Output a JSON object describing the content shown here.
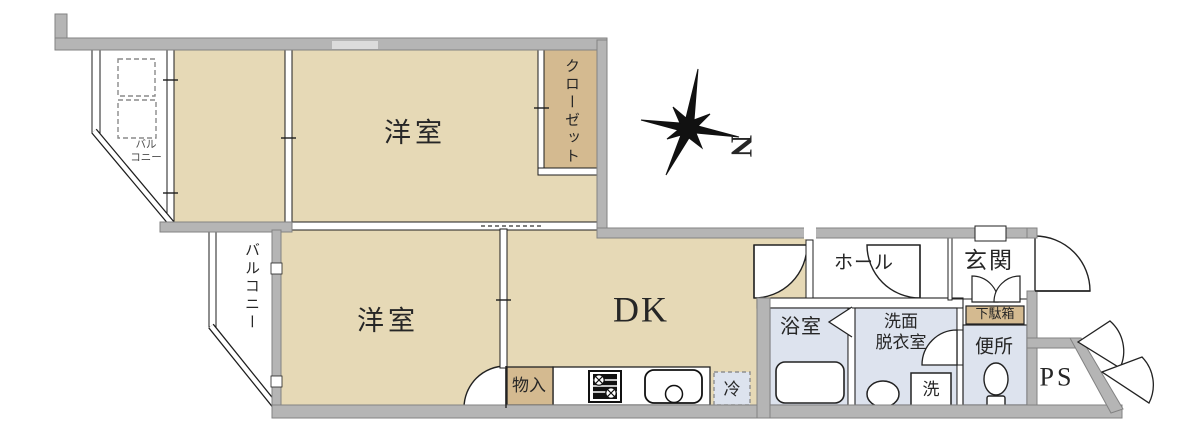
{
  "plan": {
    "title_hint": "apartment floor plan",
    "rooms": {
      "western_room_upper": "洋室",
      "western_room_lower": "洋室",
      "dining_kitchen": "DK",
      "closet": "クローゼット",
      "balcony_upper_l1": "バル",
      "balcony_upper_l2": "コニー",
      "balcony_lower": "バルコニー",
      "hall": "ホール",
      "entrance": "玄関",
      "shoe_cabinet": "下駄箱",
      "toilet_room": "便所",
      "bathroom": "浴室",
      "washroom_l1": "洗面",
      "washroom_l2": "脱衣室",
      "washer": "洗",
      "refrigerator": "冷",
      "storage": "物入",
      "pipe_space": "PS"
    },
    "compass": {
      "north": "N"
    },
    "colors": {
      "room_beige": "#e6d9b6",
      "closet_tan": "#d4ba90",
      "wet_blue": "#dde3ee",
      "wall_gray": "#b5b5b5",
      "line": "#222222"
    }
  }
}
